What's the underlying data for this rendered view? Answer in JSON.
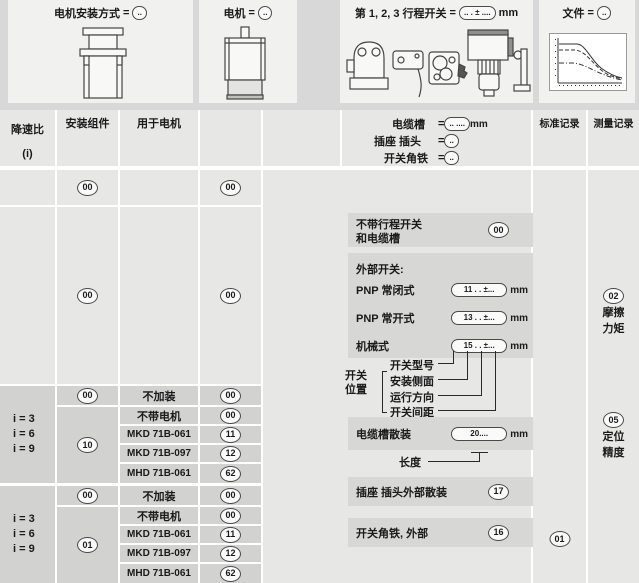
{
  "colors": {
    "page_bg": "#d8d8d8",
    "panel_bg": "#f1f1f0",
    "cell_bg": "#e7e7e6",
    "cell_dark_bg": "#d2d2d1",
    "box_bg": "#d7d7d6",
    "ink": "#1a1a1a"
  },
  "top": {
    "mount": {
      "label": "电机安装方式",
      "eq": "=",
      "code": "..",
      "icon": "motor-mount-icon"
    },
    "motor": {
      "label": "电机",
      "eq": "=",
      "code": "..",
      "icon": "motor-icon"
    },
    "switches": {
      "label": "第 1, 2, 3 行程开关",
      "eq": "=",
      "code": ".. . ± ....",
      "unit": "mm",
      "icon": "travel-switches-icons"
    },
    "file": {
      "label": "文件",
      "eq": "=",
      "code": "..",
      "icon": "document-curves-icon"
    }
  },
  "header": {
    "ratio_line1": "降速比",
    "ratio_line2": "(i)",
    "mounting": "安装组件",
    "for_motor": "用于电机",
    "cable": {
      "label": "电缆槽",
      "eq": "=",
      "code": ".. ....",
      "unit": "mm"
    },
    "plug": {
      "label": "插座 插头",
      "eq": "=",
      "code": ".."
    },
    "angle": {
      "label": "开关角铁",
      "eq": "=",
      "code": ".."
    },
    "std_record": "标准记录",
    "meas_record": "测量记录"
  },
  "table": {
    "rowA": {
      "mounting_code": "00",
      "motor_code": "00"
    },
    "rowB": {
      "mounting_code": "00",
      "motor_code": "00"
    },
    "sections": [
      {
        "ratios": [
          "i = 3",
          "i = 6",
          "i = 9"
        ],
        "none_mounting_code": "00",
        "none_label": "不加装",
        "none_code": "00",
        "mounting_code": "10",
        "motors": [
          {
            "name": "不带电机",
            "code": "00"
          },
          {
            "name": "MKD 71B-061",
            "code": "11"
          },
          {
            "name": "MKD 71B-097",
            "code": "12"
          },
          {
            "name": "MHD 71B-061",
            "code": "62"
          }
        ]
      },
      {
        "ratios": [
          "i = 3",
          "i = 6",
          "i = 9"
        ],
        "none_mounting_code": "00",
        "none_label": "不加装",
        "none_code": "00",
        "mounting_code": "01",
        "motors": [
          {
            "name": "不带电机",
            "code": "00"
          },
          {
            "name": "MKD 71B-061",
            "code": "11"
          },
          {
            "name": "MKD 71B-097",
            "code": "12"
          },
          {
            "name": "MHD 71B-061",
            "code": "62"
          }
        ]
      }
    ]
  },
  "right": {
    "no_switch": {
      "line1": "不带行程开关",
      "line2": "和电缆槽",
      "code": "00"
    },
    "external": {
      "title": "外部开关:",
      "rows": [
        {
          "label": "PNP 常闭式",
          "code": "11 . . ±...",
          "unit": "mm"
        },
        {
          "label": "PNP 常开式",
          "code": "13 . . ±...",
          "unit": "mm"
        },
        {
          "label": "机械式",
          "code": "15 . . ±...",
          "unit": "mm"
        }
      ]
    },
    "position": {
      "label_line1": "开关",
      "label_line2": "位置",
      "items": [
        "开关型号",
        "安装侧面",
        "运行方向",
        "开关间距"
      ]
    },
    "cable_bulk": {
      "label": "电缆槽散装",
      "code": "20....",
      "unit": "mm",
      "callout": "长度"
    },
    "plug_bulk": {
      "label": "插座 插头外部散装",
      "code": "17"
    },
    "angle_ext": {
      "label": "开关角铁, 外部",
      "code": "16"
    },
    "std_code": "01",
    "measurements": [
      {
        "code": "02",
        "line1": "摩擦",
        "line2": "力矩"
      },
      {
        "code": "05",
        "line1": "定位",
        "line2": "精度"
      }
    ]
  }
}
